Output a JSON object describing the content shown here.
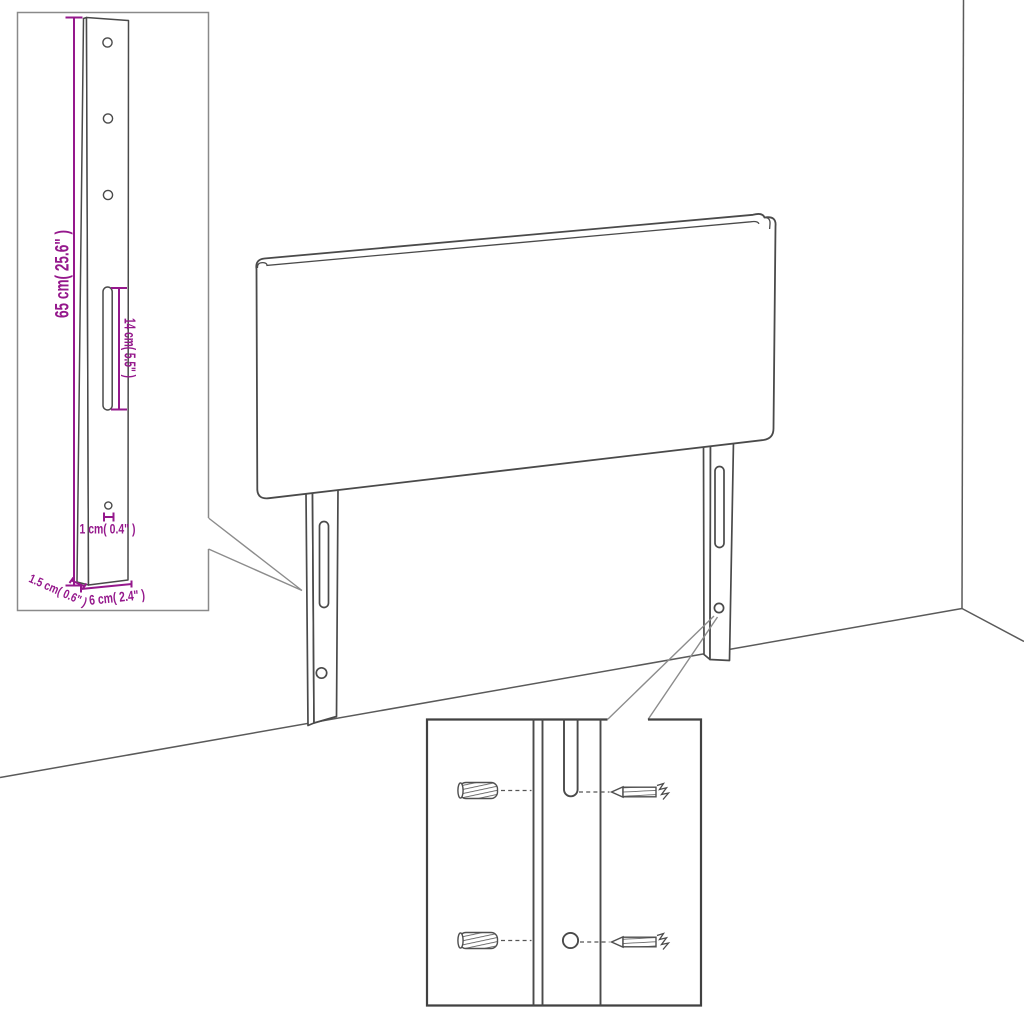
{
  "figure": {
    "title": "Headboard assembly dimension diagram",
    "colors": {
      "dimension_text": "#95188C",
      "drawing_line": "#4a4a4a",
      "background": "#ffffff"
    },
    "leg_detail_inset": {
      "height_label": "65 cm( 25.6\" )",
      "slot_height_label": "14 cm( 5.5\" )",
      "hole_diameter_label": "1 cm( 0.4\" )",
      "leg_depth_label": "1.5 cm( 0.6\" )",
      "leg_width_label": "6 cm( 2.4\" )"
    },
    "mounting_detail_inset": {
      "parts": [
        "wall-plug",
        "screw"
      ]
    }
  }
}
